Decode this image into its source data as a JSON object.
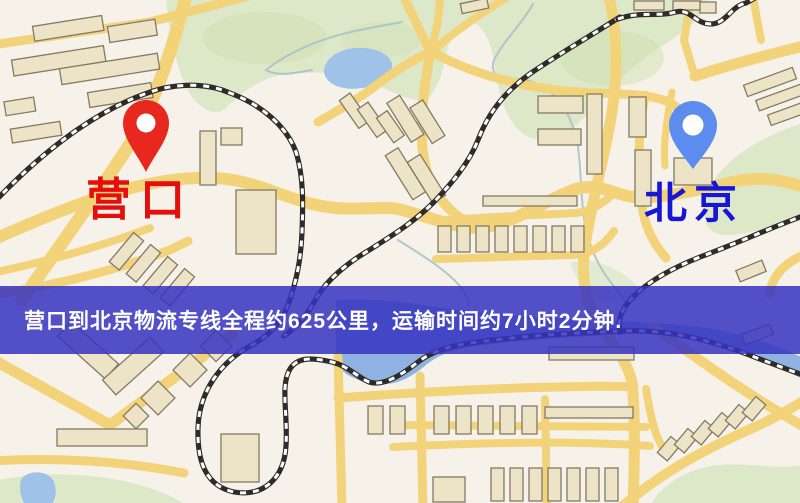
{
  "banner": {
    "text": "营口到北京物流专线全程约625公里，运输时间约7小时2分钟."
  },
  "markers": {
    "origin": {
      "label": "营口",
      "pin_color": "#e8281e",
      "label_color": "#e60d0d"
    },
    "destination": {
      "label": "北京",
      "pin_color": "#5b8cee",
      "label_color": "#1715d6"
    }
  },
  "map": {
    "type": "street-map",
    "colors": {
      "background": "#f6f2e9",
      "road": "#f3d37a",
      "water": "#9ec2e8",
      "river": "#8fb2e2",
      "green": "#dde8c9",
      "green_dark": "#cfdfb2",
      "building_fill": "#ede3c6",
      "building_stroke": "#837a64",
      "railway": "#2e2b28",
      "stream": "#a3bfc9",
      "banner": "rgba(54,51,191,0.85)"
    }
  }
}
